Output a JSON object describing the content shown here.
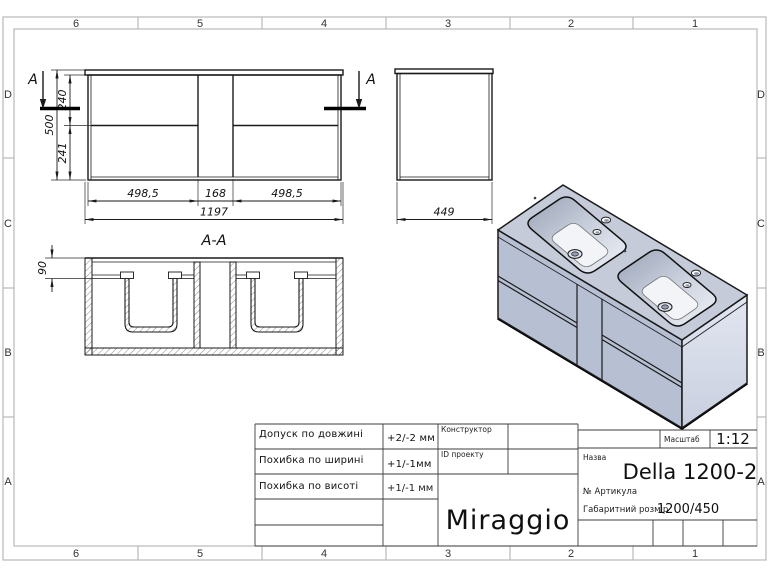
{
  "frame": {
    "columns": [
      "6",
      "5",
      "4",
      "3",
      "2",
      "1"
    ],
    "rows": [
      "D",
      "C",
      "B",
      "A"
    ]
  },
  "drawing": {
    "front": {
      "h_top": "240",
      "h_total": "500",
      "h_bottom": "241",
      "w_left": "498,5",
      "w_mid": "168",
      "w_right": "498,5",
      "w_total": "1197",
      "section_label": "A"
    },
    "side": {
      "depth": "449"
    },
    "section": {
      "title": "A-A",
      "basin_depth": "90"
    }
  },
  "title_block": {
    "tolerances": [
      {
        "label": "Допуск по довжині",
        "value": "+2/-2 мм"
      },
      {
        "label": "Похибка по ширині",
        "value": "+1/-1мм"
      },
      {
        "label": "Похибка по висоті",
        "value": "+1/-1 мм"
      }
    ],
    "constructor_label": "Конструктор",
    "project_id_label": "ID проекту",
    "brand": "Miraggio",
    "scale_label": "Масштаб",
    "scale_value": "1:12",
    "name_label": "Назва",
    "product_name": "Della 1200-2",
    "article_label": "№ Артикула",
    "dimensions_label": "Габаритний розмір",
    "dimensions_value": "1200/450"
  },
  "colors": {
    "cabinet_top": "#c5cbd9",
    "cabinet_front": "#b7bfd3",
    "cabinet_side": "#dde1ed",
    "outline": "#1a1a1a"
  }
}
